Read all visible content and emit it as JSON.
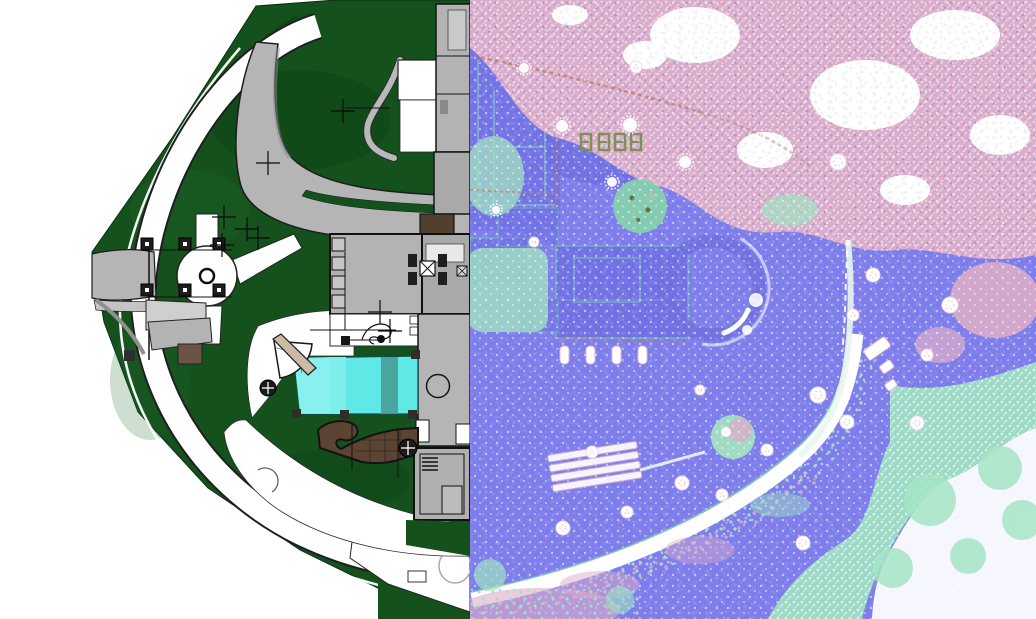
{
  "meta": {
    "view": "split-comparison",
    "width": 1036,
    "height": 619,
    "split_x": 470,
    "left_panel_label": "landscape site plan rendering",
    "right_panel_label": "aerial lidar point cloud scan"
  },
  "colors": {
    "canvas_bg": "#ffffff",
    "site_green": "#15511d",
    "lawn_dark": "#0c3f14",
    "lawn_light": "#226b2c",
    "road_gray": "#b5b5b5",
    "road_light": "#c6c6c6",
    "outline_dark": "#1c1c1c",
    "roof_gray": "#b3b3b3",
    "roof_gray_dark": "#a9a9a9",
    "pool_cyan": "#5fe8e6",
    "pool_cyan_light": "#8df2f0",
    "pool_teal_stripe": "#4a9e99",
    "deck_brown": "#5c4434",
    "shed_brown": "#6b5445",
    "door_brown": "#52402f",
    "ramp_beige": "#cbbba4",
    "pc_purple": "#7d7dee",
    "pc_purple_dark": "#6c6ce2",
    "pc_pink": "#dcabc9",
    "pc_mint": "#a0e3c1",
    "pc_white": "#ffffff",
    "pc_olive": "#7d9055",
    "pc_rust": "#b87a68"
  },
  "features": {
    "site_plan": [
      "perimeter-planting-band",
      "ring-path",
      "entry-drive",
      "gate-posts",
      "fountain-court",
      "curved-driveway",
      "main-residence",
      "tower-wing",
      "swimming-pool",
      "timber-deck",
      "garden-sheds",
      "lower-pavilion",
      "survey-crosses",
      "quarter-fan-terrace"
    ],
    "point_cloud": [
      "tree-canopy",
      "building-footprint",
      "circular-drive",
      "colonnade",
      "bleacher-steps",
      "sweeping-path",
      "scan-voids",
      "scan-targets",
      "vegetation-swath",
      "parked-cars"
    ]
  },
  "markers": {
    "survey_crosses": [
      [
        343,
        111
      ],
      [
        268,
        163
      ],
      [
        224,
        217
      ],
      [
        247,
        229
      ],
      [
        222,
        245
      ],
      [
        258,
        238
      ],
      [
        380,
        312
      ],
      [
        390,
        331
      ]
    ],
    "gate_posts": [
      [
        147,
        244
      ],
      [
        185,
        244
      ],
      [
        219,
        244
      ],
      [
        147,
        290
      ],
      [
        185,
        290
      ],
      [
        219,
        290
      ]
    ],
    "pool_posts": [
      [
        291,
        351
      ],
      [
        411,
        350
      ],
      [
        292,
        409
      ],
      [
        340,
        410
      ],
      [
        408,
        410
      ]
    ],
    "roof_bays": [
      [
        332,
        238
      ],
      [
        332,
        257
      ],
      [
        332,
        276
      ],
      [
        332,
        295
      ]
    ],
    "court_squares": [
      [
        423,
        342
      ],
      [
        437,
        342
      ],
      [
        451,
        342
      ]
    ],
    "pinwheel_trees": [
      [
        268,
        388,
        8
      ],
      [
        408,
        448,
        9
      ]
    ],
    "colonnade_pillars": [
      [
        560,
        346
      ],
      [
        586,
        346
      ],
      [
        612,
        346
      ],
      [
        638,
        346
      ]
    ],
    "scan_voids": [
      [
        563,
        528,
        7
      ],
      [
        627,
        512,
        6
      ],
      [
        682,
        483,
        7
      ],
      [
        722,
        495,
        6
      ],
      [
        767,
        450,
        6
      ],
      [
        803,
        543,
        7
      ],
      [
        818,
        395,
        8
      ],
      [
        847,
        422,
        7
      ],
      [
        917,
        423,
        7
      ],
      [
        838,
        162,
        8
      ],
      [
        950,
        305,
        8
      ],
      [
        927,
        355,
        6
      ],
      [
        853,
        315,
        6
      ],
      [
        873,
        275,
        7
      ],
      [
        636,
        67,
        6
      ],
      [
        534,
        242,
        5
      ],
      [
        700,
        390,
        5
      ],
      [
        592,
        452,
        6
      ]
    ],
    "target_stars": [
      [
        562,
        126,
        6
      ],
      [
        630,
        125,
        7
      ],
      [
        685,
        162,
        6
      ],
      [
        612,
        182,
        5
      ],
      [
        524,
        68,
        5
      ],
      [
        496,
        210,
        4
      ]
    ],
    "glyph_marks": [
      [
        581,
        134
      ],
      [
        599,
        134
      ],
      [
        615,
        134
      ],
      [
        631,
        134
      ]
    ]
  }
}
